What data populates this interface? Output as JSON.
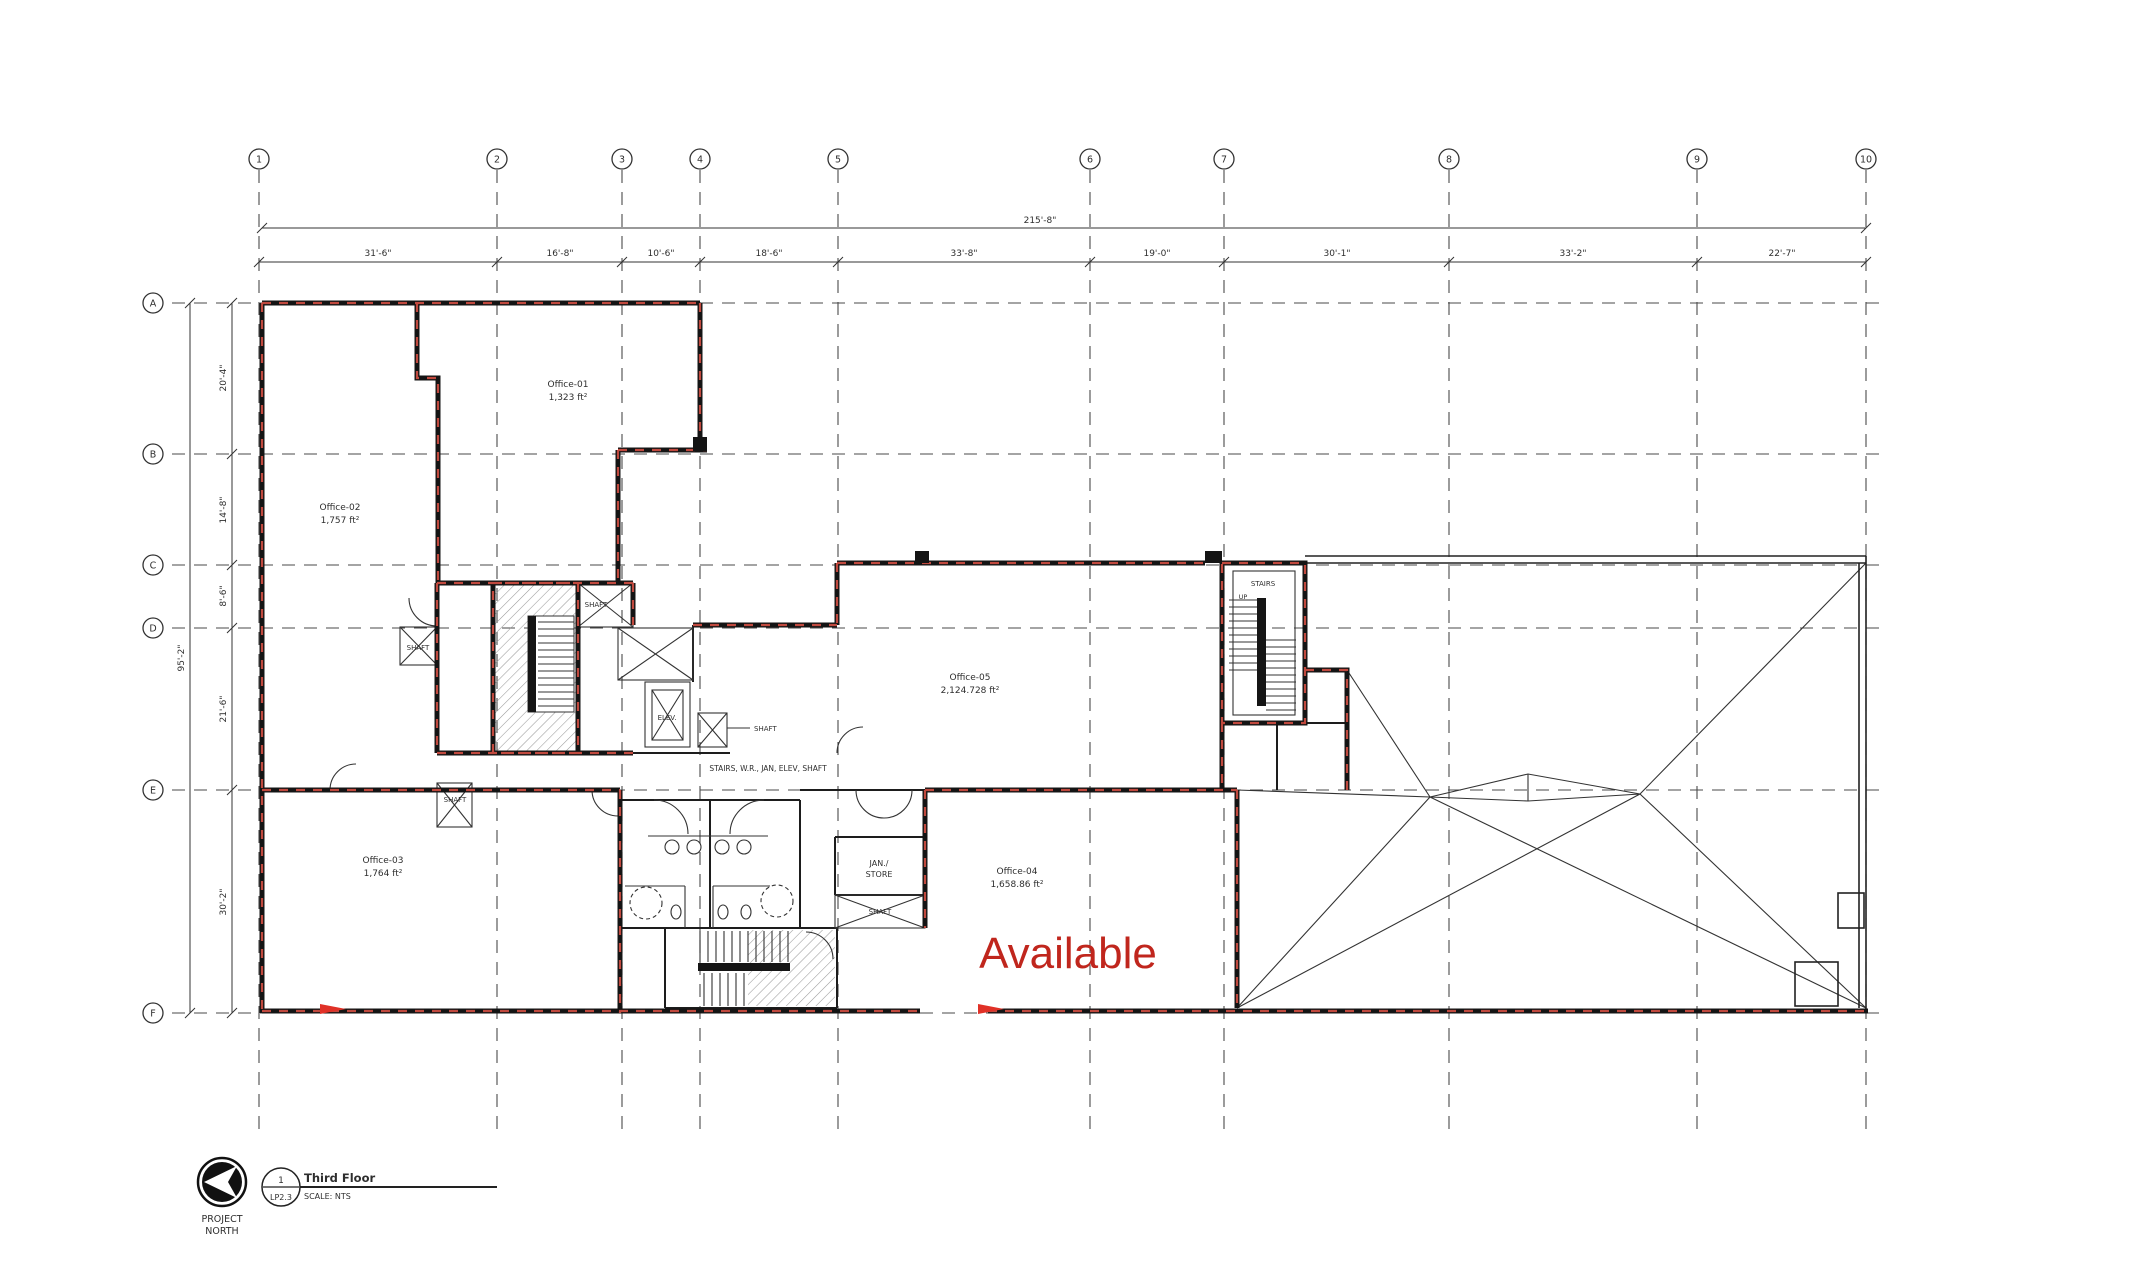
{
  "plan": {
    "grid": {
      "columns": [
        "1",
        "2",
        "3",
        "4",
        "5",
        "6",
        "7",
        "8",
        "9",
        "10"
      ],
      "rows": [
        "A",
        "B",
        "C",
        "D",
        "E",
        "F"
      ]
    },
    "dims": {
      "total_width": "215'-8\"",
      "col_spans": [
        "31'-6\"",
        "16'-8\"",
        "10'-6\"",
        "18'-6\"",
        "33'-8\"",
        "19'-0\"",
        "30'-1\"",
        "33'-2\"",
        "22'-7\""
      ],
      "total_height": "95'-2\"",
      "row_spans": [
        "20'-4\"",
        "14'-8\"",
        "8'-6\"",
        "21'-6\"",
        "30'-2\""
      ]
    },
    "rooms": {
      "office01_name": "Office-01",
      "office01_area": "1,323 ft²",
      "office02_name": "Office-02",
      "office02_area": "1,757 ft²",
      "office03_name": "Office-03",
      "office03_area": "1,764 ft²",
      "office04_name": "Office-04",
      "office04_area": "1,658.86 ft²",
      "office05_name": "Office-05",
      "office05_area": "2,124.728 ft²",
      "jan_line1": "JAN./",
      "jan_line2": "STORE",
      "shaft": "SHAFT",
      "elev": "ELEV.",
      "stairs": "STAIRS",
      "up": "UP",
      "core_note": "STAIRS, W.R., JAN, ELEV, SHAFT"
    },
    "available": "Available",
    "accent_red": "#c0261d",
    "wall_rating_red": "#c0493e",
    "title_block": {
      "bubble_top": "1",
      "bubble_bottom": "LP2.3",
      "title": "Third Floor",
      "scale": "SCALE: NTS",
      "north_line1": "PROJECT",
      "north_line2": "NORTH"
    }
  }
}
